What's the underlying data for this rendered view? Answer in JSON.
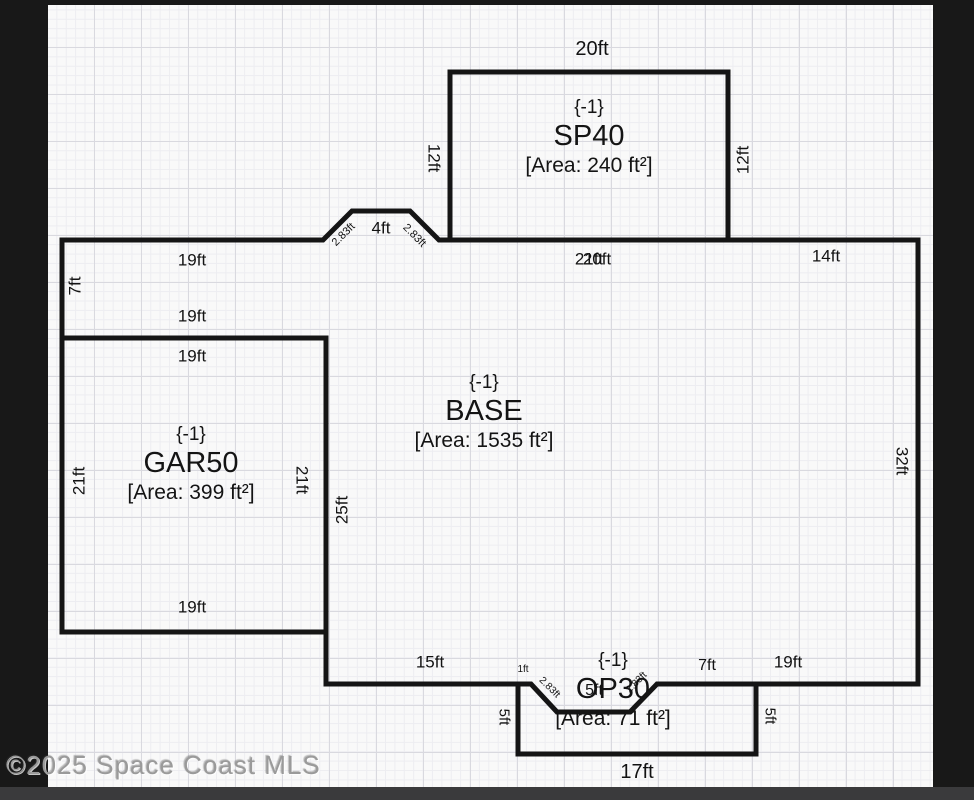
{
  "watermark": {
    "text": "©2025 Space Coast MLS"
  },
  "rooms": {
    "sp40": {
      "code": "{-1}",
      "name": "SP40",
      "area": "[Area: 240 ft²]"
    },
    "base": {
      "code": "{-1}",
      "name": "BASE",
      "area": "[Area: 1535 ft²]"
    },
    "gar50": {
      "code": "{-1}",
      "name": "GAR50",
      "area": "[Area: 399 ft²]"
    },
    "op30": {
      "code": "{-1}",
      "name": "OP30",
      "area": "[Area: 71 ft²]"
    }
  },
  "labels": [
    {
      "name": "dim-sp40-width",
      "text": "20ft",
      "x": 592,
      "y": 49,
      "size": 20,
      "rot": 0
    },
    {
      "name": "dim-sp40-left",
      "text": "12ft",
      "x": 434,
      "y": 158,
      "size": 17,
      "rot": 90
    },
    {
      "name": "dim-sp40-right",
      "text": "12ft",
      "x": 743,
      "y": 160,
      "size": 17,
      "rot": -90
    },
    {
      "name": "dim-bump-left-slope",
      "text": "2.83ft",
      "x": 344,
      "y": 235,
      "size": 11,
      "rot": -45
    },
    {
      "name": "dim-bump-top",
      "text": "4ft",
      "x": 381,
      "y": 228,
      "size": 17,
      "rot": 0
    },
    {
      "name": "dim-bump-right-slope",
      "text": "2.83ft",
      "x": 414,
      "y": 236,
      "size": 11,
      "rot": 45
    },
    {
      "name": "dim-base-top-left",
      "text": "19ft",
      "x": 192,
      "y": 260,
      "size": 17,
      "rot": 0
    },
    {
      "name": "dim-base-top-mid-21ft",
      "text": "21ft",
      "x": 589,
      "y": 259,
      "size": 17,
      "rot": 0
    },
    {
      "name": "dim-base-top-mid-20ft",
      "text": "20ft",
      "x": 597,
      "y": 259,
      "size": 17,
      "rot": 0
    },
    {
      "name": "dim-base-top-right",
      "text": "14ft",
      "x": 826,
      "y": 256,
      "size": 17,
      "rot": 0
    },
    {
      "name": "dim-left-7ft",
      "text": "7ft",
      "x": 75,
      "y": 286,
      "size": 17,
      "rot": -90
    },
    {
      "name": "dim-gar50-above-top",
      "text": "19ft",
      "x": 192,
      "y": 316,
      "size": 17,
      "rot": 0
    },
    {
      "name": "dim-gar50-top",
      "text": "19ft",
      "x": 192,
      "y": 356,
      "size": 17,
      "rot": 0
    },
    {
      "name": "dim-gar50-left",
      "text": "21ft",
      "x": 79,
      "y": 481,
      "size": 17,
      "rot": -90
    },
    {
      "name": "dim-gar50-right",
      "text": "21ft",
      "x": 302,
      "y": 480,
      "size": 17,
      "rot": 90
    },
    {
      "name": "dim-base-left-wall",
      "text": "25ft",
      "x": 342,
      "y": 510,
      "size": 17,
      "rot": -90
    },
    {
      "name": "dim-base-right-wall",
      "text": "32ft",
      "x": 902,
      "y": 461,
      "size": 17,
      "rot": 90
    },
    {
      "name": "dim-gar50-bottom",
      "text": "19ft",
      "x": 192,
      "y": 607,
      "size": 17,
      "rot": 0
    },
    {
      "name": "dim-base-bottom-left",
      "text": "15ft",
      "x": 430,
      "y": 662,
      "size": 17,
      "rot": 0
    },
    {
      "name": "dim-notch-1ft",
      "text": "1ft",
      "x": 523,
      "y": 670,
      "size": 10,
      "rot": 0
    },
    {
      "name": "dim-notch-left-slope",
      "text": "2.83ft",
      "x": 549,
      "y": 688,
      "size": 10,
      "rot": 45
    },
    {
      "name": "dim-notch-bottom",
      "text": "5ft",
      "x": 594,
      "y": 691,
      "size": 16,
      "rot": 0
    },
    {
      "name": "dim-notch-right-slope",
      "text": "2.83ft",
      "x": 637,
      "y": 683,
      "size": 10,
      "rot": -45
    },
    {
      "name": "dim-base-bottom-7ft",
      "text": "7ft",
      "x": 707,
      "y": 666,
      "size": 16,
      "rot": 0
    },
    {
      "name": "dim-base-bottom-right",
      "text": "19ft",
      "x": 788,
      "y": 662,
      "size": 17,
      "rot": 0
    },
    {
      "name": "dim-op30-left",
      "text": "5ft",
      "x": 504,
      "y": 717,
      "size": 15,
      "rot": 90
    },
    {
      "name": "dim-op30-right",
      "text": "5ft",
      "x": 770,
      "y": 716,
      "size": 15,
      "rot": 90
    },
    {
      "name": "dim-op30-bottom",
      "text": "17ft",
      "x": 637,
      "y": 772,
      "size": 20,
      "rot": 0
    }
  ]
}
